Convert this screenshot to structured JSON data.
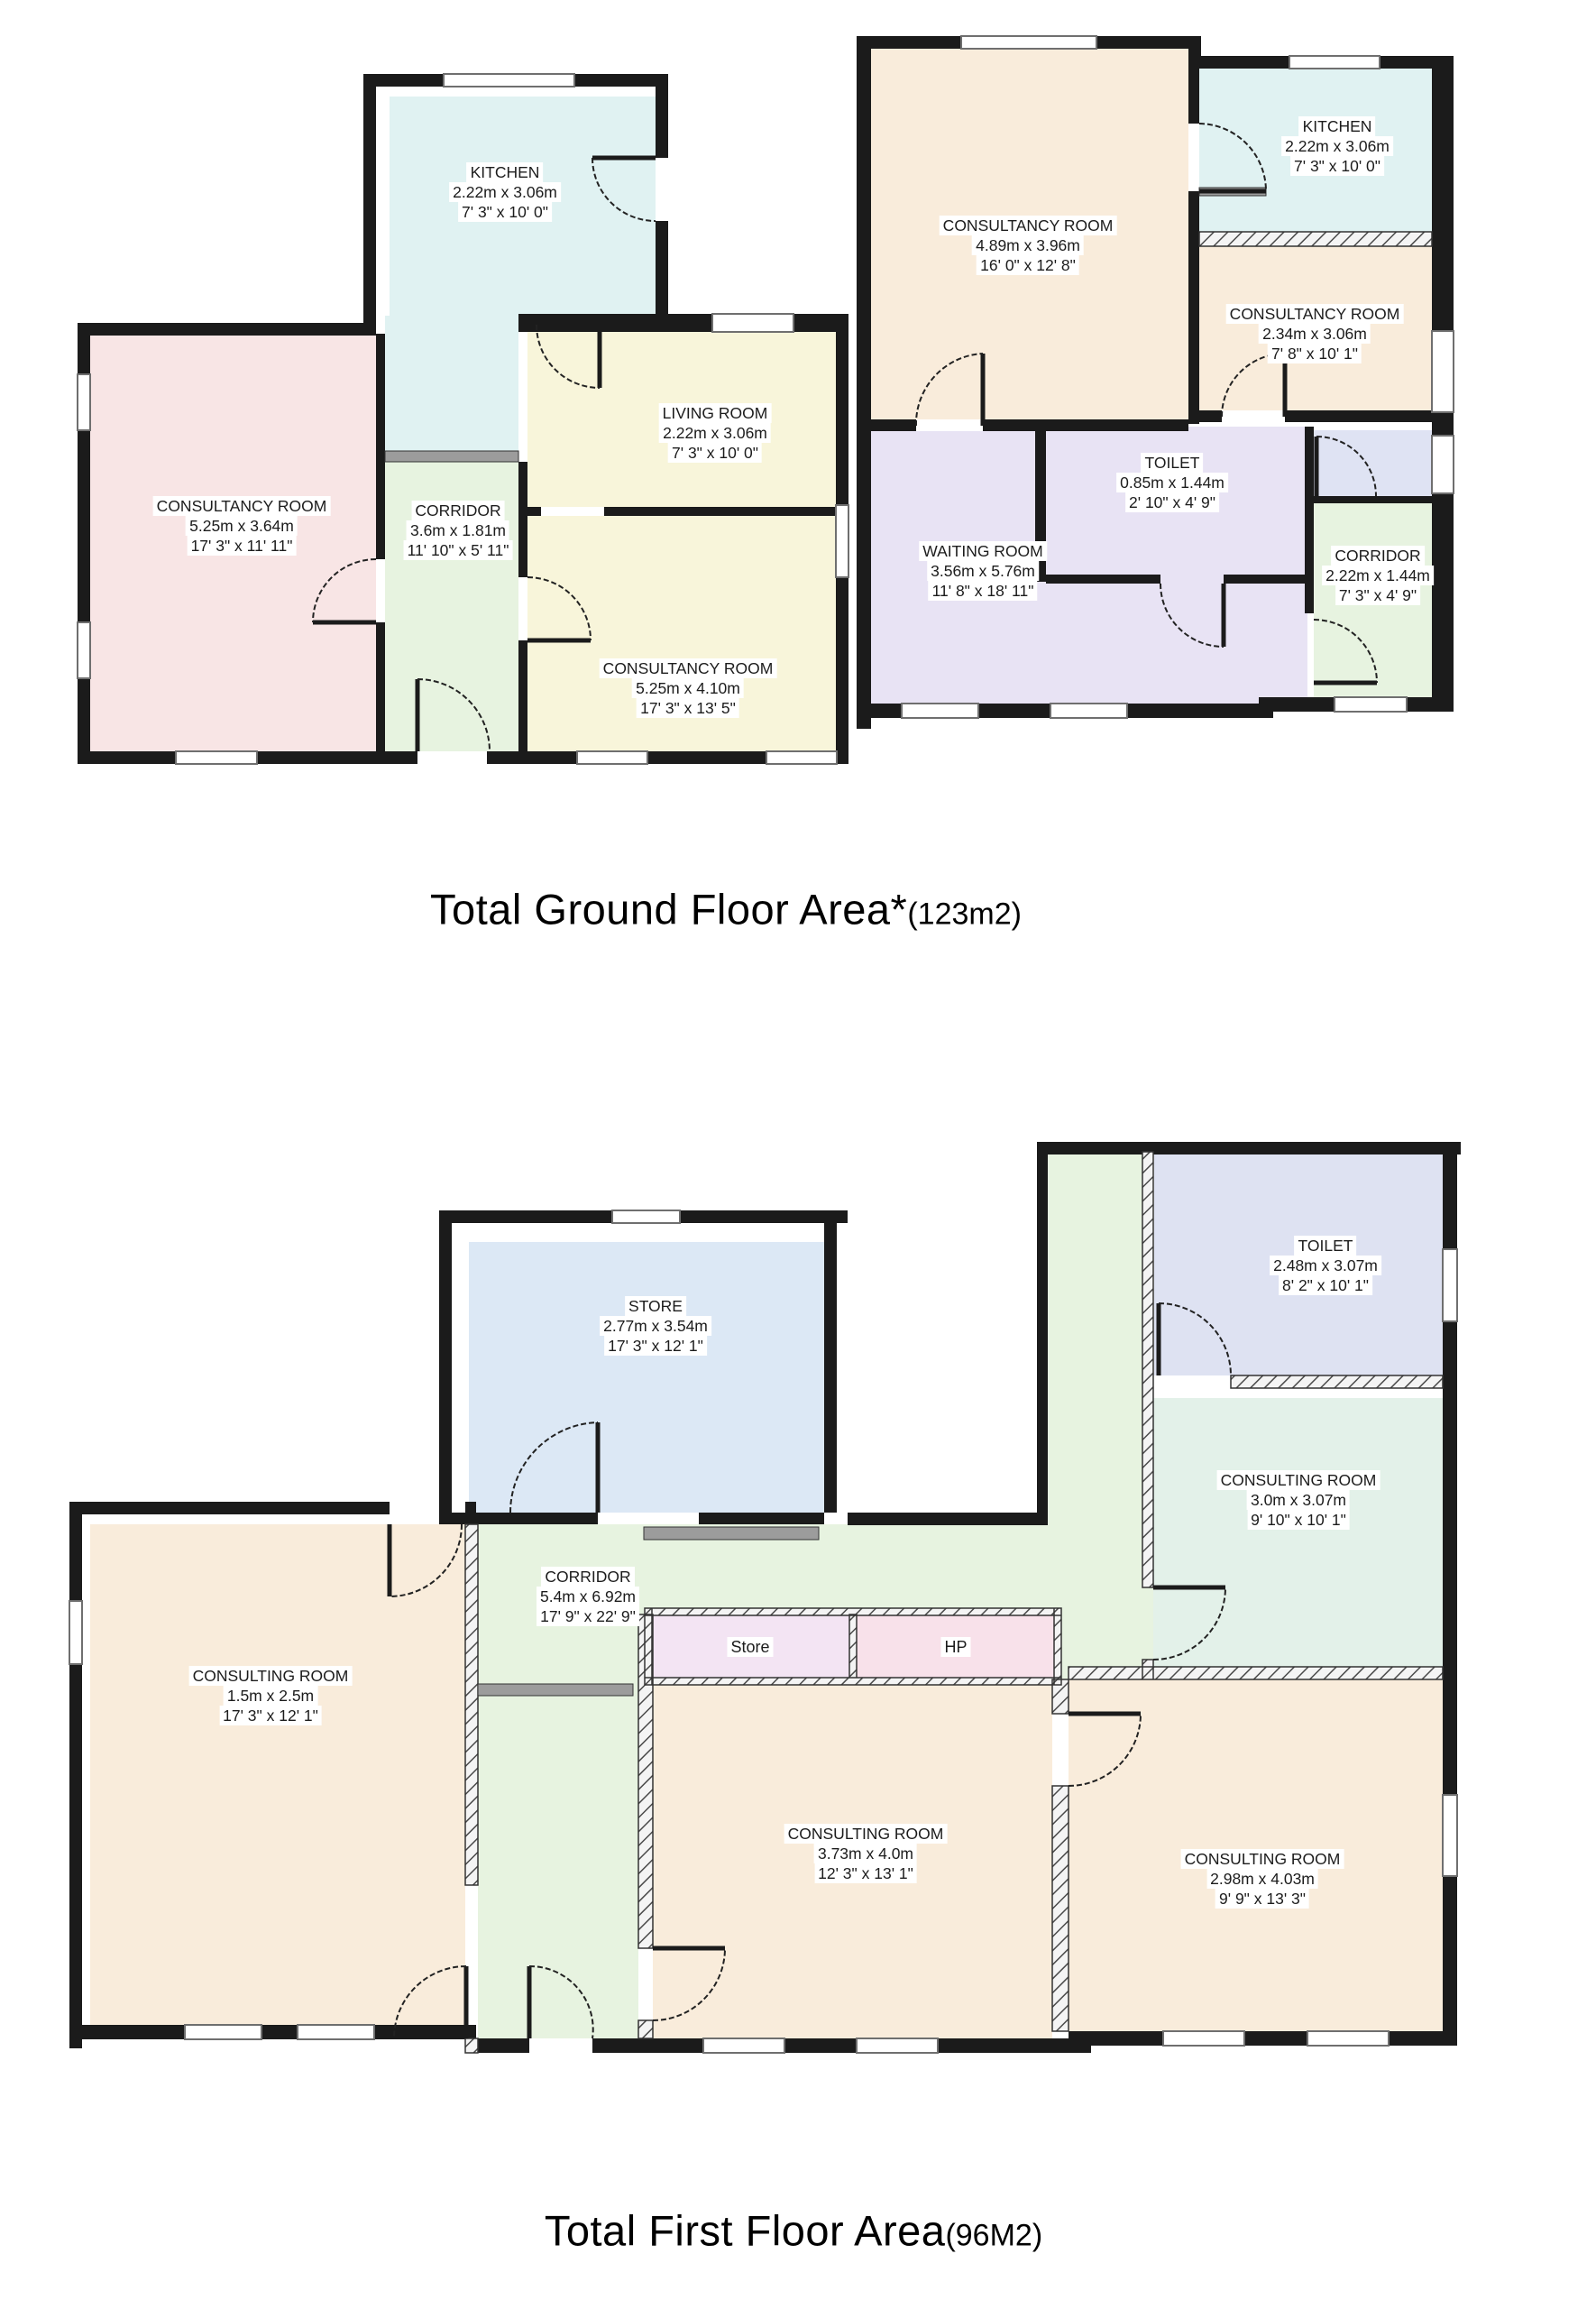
{
  "titles": {
    "ground": {
      "main": "Total Ground Floor Area*",
      "area": "(123m2)"
    },
    "first": {
      "main": "Total First Floor Area",
      "area": "(96M2)"
    }
  },
  "colors": {
    "wall": "#1b1b1b",
    "sill": "#9c9c9c",
    "kitchen": "#e0f2f2",
    "pink": "#f8e5e5",
    "corridor_green": "#e7f3e0",
    "cream": "#f8f5da",
    "peach": "#f9ecdb",
    "lavender": "#e8e3f4",
    "blue_small": "#dfe3f3",
    "store_blue": "#dce8f5",
    "mint": "#e3f1e9",
    "toilet_blue": "#dee2f2",
    "closet_store": "#f3e4f3",
    "closet_hp": "#f8e1ea"
  },
  "ground_floor": {
    "rooms": [
      {
        "name": "KITCHEN",
        "dims_m": "2.22m x 3.06m",
        "dims_ft": "7' 3\" x 10' 0\""
      },
      {
        "name": "CONSULTANCY ROOM",
        "dims_m": "5.25m x 3.64m",
        "dims_ft": "17' 3\" x 11' 11\""
      },
      {
        "name": "CORRIDOR",
        "dims_m": "3.6m x 1.81m",
        "dims_ft": "11' 10\" x 5' 11\""
      },
      {
        "name": "LIVING ROOM",
        "dims_m": "2.22m x 3.06m",
        "dims_ft": "7' 3\" x 10' 0\""
      },
      {
        "name": "CONSULTANCY ROOM",
        "dims_m": "5.25m x 4.10m",
        "dims_ft": "17' 3\" x 13' 5\""
      },
      {
        "name": "CONSULTANCY ROOM",
        "dims_m": "4.89m x 3.96m",
        "dims_ft": "16' 0\" x 12' 8\""
      },
      {
        "name": "KITCHEN",
        "dims_m": "2.22m x 3.06m",
        "dims_ft": "7' 3\" x 10' 0\""
      },
      {
        "name": "CONSULTANCY ROOM",
        "dims_m": "2.34m x 3.06m",
        "dims_ft": "7' 8\" x 10' 1\""
      },
      {
        "name": "TOILET",
        "dims_m": "0.85m x 1.44m",
        "dims_ft": "2' 10\" x 4' 9\""
      },
      {
        "name": "WAITING  ROOM",
        "dims_m": "3.56m x 5.76m",
        "dims_ft": "11' 8\" x 18' 11\""
      },
      {
        "name": "CORRIDOR",
        "dims_m": "2.22m x 1.44m",
        "dims_ft": "7' 3\" x 4' 9\""
      }
    ]
  },
  "first_floor": {
    "rooms": [
      {
        "name": "STORE",
        "dims_m": "2.77m x 3.54m",
        "dims_ft": "17' 3\" x  12' 1\""
      },
      {
        "name": "CORRIDOR",
        "dims_m": "5.4m x 6.92m",
        "dims_ft": "17' 9\" x  22' 9\""
      },
      {
        "name": "Store"
      },
      {
        "name": "HP"
      },
      {
        "name": "TOILET",
        "dims_m": "2.48m x 3.07m",
        "dims_ft": "8' 2\" x  10' 1\""
      },
      {
        "name": "CONSULTING ROOM",
        "dims_m": "3.0m x 3.07m",
        "dims_ft": "9' 10\" x  10' 1\""
      },
      {
        "name": "CONSULTING ROOM",
        "dims_m": "1.5m x 2.5m",
        "dims_ft": "17' 3\" x  12' 1\""
      },
      {
        "name": "CONSULTING ROOM",
        "dims_m": "3.73m x 4.0m",
        "dims_ft": "12' 3\" x  13' 1\""
      },
      {
        "name": "CONSULTING ROOM",
        "dims_m": "2.98m x 4.03m",
        "dims_ft": "9' 9\" x  13' 3\""
      }
    ]
  }
}
